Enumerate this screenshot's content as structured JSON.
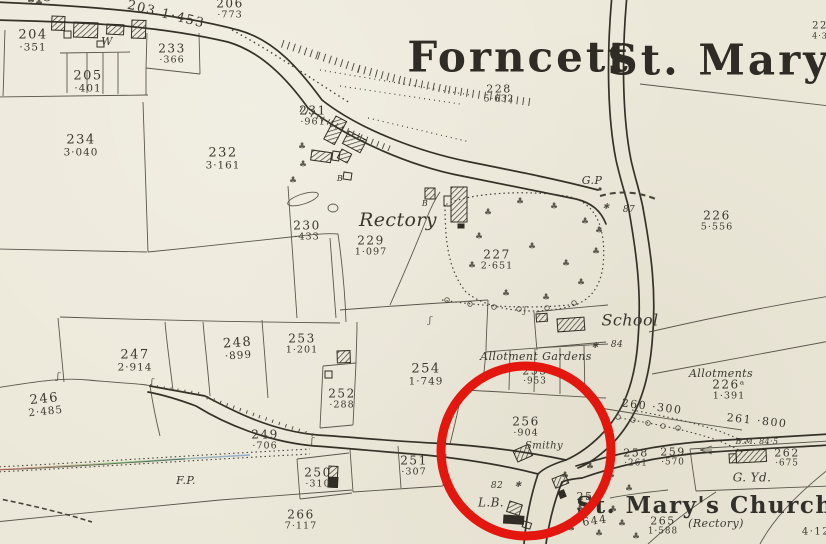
{
  "map": {
    "sheet_title": "Forncett St. Mary",
    "colors": {
      "paper": "#ece8d9",
      "ink": "#3a382e",
      "annotation_red": "#e3170e"
    },
    "annotation": {
      "shape": "circle",
      "purpose": "highlight-smithy-parcel-256"
    },
    "labels": [
      {
        "name": "title-forncett",
        "lines": [
          "Forncett"
        ],
        "x": 519,
        "y": 58,
        "size": 42,
        "style": "title"
      },
      {
        "name": "title-st-mary",
        "lines": [
          "St. Mary"
        ],
        "x": 719,
        "y": 61,
        "size": 42,
        "style": "title"
      },
      {
        "name": "label-st-marys-church",
        "lines": [
          "St. Mary's Church"
        ],
        "x": 705,
        "y": 506,
        "size": 23,
        "style": "title2"
      },
      {
        "name": "parcel-204",
        "lines": [
          "204",
          "·351"
        ],
        "x": 33,
        "y": 41,
        "size": 13,
        "style": "num"
      },
      {
        "name": "parcel-205",
        "lines": [
          "205",
          "·401"
        ],
        "x": 88,
        "y": 82,
        "size": 13,
        "style": "num"
      },
      {
        "name": "parcel-203",
        "lines": [
          "203 1·453"
        ],
        "x": 166,
        "y": 15,
        "size": 13,
        "style": "num",
        "rot": 14
      },
      {
        "name": "parcel-206",
        "lines": [
          "206",
          "·773"
        ],
        "x": 230,
        "y": 9,
        "size": 12,
        "style": "num"
      },
      {
        "name": "parcel-233",
        "lines": [
          "233",
          "·366"
        ],
        "x": 172,
        "y": 54,
        "size": 12,
        "style": "num"
      },
      {
        "name": "parcel-234",
        "lines": [
          "234",
          "3·040"
        ],
        "x": 81,
        "y": 146,
        "size": 13,
        "style": "num"
      },
      {
        "name": "parcel-232",
        "lines": [
          "232",
          "3·161"
        ],
        "x": 223,
        "y": 159,
        "size": 13,
        "style": "num"
      },
      {
        "name": "parcel-231",
        "lines": [
          "231",
          "·961"
        ],
        "x": 313,
        "y": 116,
        "size": 12,
        "style": "num"
      },
      {
        "name": "parcel-230",
        "lines": [
          "230",
          "·433"
        ],
        "x": 307,
        "y": 231,
        "size": 12,
        "style": "num"
      },
      {
        "name": "label-rectory",
        "lines": [
          "Rectory"
        ],
        "x": 398,
        "y": 220,
        "size": 19,
        "style": "italic"
      },
      {
        "name": "parcel-229",
        "lines": [
          "229",
          "1·097"
        ],
        "x": 371,
        "y": 246,
        "size": 12,
        "style": "num"
      },
      {
        "name": "parcel-228",
        "lines": [
          "228",
          "5·632"
        ],
        "x": 499,
        "y": 94,
        "size": 11,
        "style": "num"
      },
      {
        "name": "parcel-227",
        "lines": [
          "227",
          "2·651"
        ],
        "x": 497,
        "y": 260,
        "size": 12,
        "style": "num"
      },
      {
        "name": "parcel-226",
        "lines": [
          "226",
          "5·556"
        ],
        "x": 717,
        "y": 221,
        "size": 12,
        "style": "num"
      },
      {
        "name": "parcel-22x-partial",
        "lines": [
          "22",
          "4·3"
        ],
        "x": 820,
        "y": 31,
        "size": 10,
        "style": "num"
      },
      {
        "name": "label-gp",
        "lines": [
          "G.P"
        ],
        "x": 592,
        "y": 181,
        "size": 11,
        "style": "italic"
      },
      {
        "name": "spot-height-87",
        "lines": [
          "87"
        ],
        "x": 629,
        "y": 211,
        "size": 9,
        "style": "italic"
      },
      {
        "name": "label-school",
        "lines": [
          "School"
        ],
        "x": 630,
        "y": 321,
        "size": 16,
        "style": "italic"
      },
      {
        "name": "spot-height-84",
        "lines": [
          "84"
        ],
        "x": 617,
        "y": 346,
        "size": 9,
        "style": "italic"
      },
      {
        "name": "label-allotments",
        "lines": [
          "Allotments"
        ],
        "x": 721,
        "y": 374,
        "size": 11,
        "style": "italic"
      },
      {
        "name": "parcel-226a",
        "lines": [
          "226ᵃ",
          "1·391"
        ],
        "x": 729,
        "y": 390,
        "size": 12,
        "style": "num"
      },
      {
        "name": "parcel-247",
        "lines": [
          "247",
          "2·914"
        ],
        "x": 135,
        "y": 361,
        "size": 13,
        "style": "num"
      },
      {
        "name": "parcel-248",
        "lines": [
          "248",
          "·899"
        ],
        "x": 238,
        "y": 349,
        "size": 13,
        "style": "num",
        "rot": -4
      },
      {
        "name": "parcel-253",
        "lines": [
          "253",
          "1·201"
        ],
        "x": 302,
        "y": 344,
        "size": 12,
        "style": "num"
      },
      {
        "name": "parcel-246",
        "lines": [
          "246",
          "2·485"
        ],
        "x": 45,
        "y": 405,
        "size": 13,
        "style": "num",
        "rot": -6
      },
      {
        "name": "parcel-249",
        "lines": [
          "249",
          "·706"
        ],
        "x": 265,
        "y": 440,
        "size": 12,
        "style": "num"
      },
      {
        "name": "parcel-250",
        "lines": [
          "250",
          "·310"
        ],
        "x": 318,
        "y": 478,
        "size": 12,
        "style": "num"
      },
      {
        "name": "parcel-251",
        "lines": [
          "251",
          "·307"
        ],
        "x": 414,
        "y": 466,
        "size": 12,
        "style": "num"
      },
      {
        "name": "label-fp",
        "lines": [
          "F.P."
        ],
        "x": 186,
        "y": 481,
        "size": 11,
        "style": "italic"
      },
      {
        "name": "parcel-266",
        "lines": [
          "266",
          "7·117"
        ],
        "x": 301,
        "y": 520,
        "size": 12,
        "style": "num"
      },
      {
        "name": "parcel-252",
        "lines": [
          "252",
          "·288"
        ],
        "x": 342,
        "y": 399,
        "size": 12,
        "style": "num"
      },
      {
        "name": "parcel-254",
        "lines": [
          "254",
          "1·749"
        ],
        "x": 426,
        "y": 375,
        "size": 13,
        "style": "num"
      },
      {
        "name": "label-allotment-gardens",
        "lines": [
          "Allotment Gardens"
        ],
        "x": 536,
        "y": 357,
        "size": 11,
        "style": "italic"
      },
      {
        "name": "parcel-255",
        "lines": [
          "255",
          "·953"
        ],
        "x": 535,
        "y": 376,
        "size": 11,
        "style": "num"
      },
      {
        "name": "parcel-256",
        "lines": [
          "256",
          "·904"
        ],
        "x": 526,
        "y": 427,
        "size": 12,
        "style": "num"
      },
      {
        "name": "label-smithy",
        "lines": [
          "Smithy"
        ],
        "x": 544,
        "y": 447,
        "size": 10,
        "style": "italic"
      },
      {
        "name": "spot-height-82",
        "lines": [
          "82"
        ],
        "x": 497,
        "y": 487,
        "size": 9,
        "style": "italic"
      },
      {
        "name": "label-lb",
        "lines": [
          "L.B."
        ],
        "x": 491,
        "y": 503,
        "size": 12,
        "style": "italic"
      },
      {
        "name": "parcel-260",
        "lines": [
          "260 ·300"
        ],
        "x": 652,
        "y": 407,
        "size": 11,
        "style": "num",
        "rot": 7
      },
      {
        "name": "parcel-261",
        "lines": [
          "261 ·800"
        ],
        "x": 757,
        "y": 421,
        "size": 11,
        "style": "num",
        "rot": 6
      },
      {
        "name": "parcel-258",
        "lines": [
          "258",
          "·261"
        ],
        "x": 636,
        "y": 458,
        "size": 11,
        "style": "num"
      },
      {
        "name": "parcel-259",
        "lines": [
          "259",
          "·570"
        ],
        "x": 673,
        "y": 457,
        "size": 11,
        "style": "num"
      },
      {
        "name": "benchmark-bm-845",
        "lines": [
          "B.M. 84·5"
        ],
        "x": 757,
        "y": 442,
        "size": 8,
        "style": "italic"
      },
      {
        "name": "parcel-262",
        "lines": [
          "262",
          "·675"
        ],
        "x": 787,
        "y": 458,
        "size": 11,
        "style": "num"
      },
      {
        "name": "label-g-yd",
        "lines": [
          "G. Yd."
        ],
        "x": 752,
        "y": 478,
        "size": 12,
        "style": "italic"
      },
      {
        "name": "parcel-265",
        "lines": [
          "265",
          "1·588"
        ],
        "x": 663,
        "y": 526,
        "size": 11,
        "style": "num"
      },
      {
        "name": "label-rectory-paren",
        "lines": [
          "(Rectory)"
        ],
        "x": 716,
        "y": 524,
        "size": 11,
        "style": "italic"
      },
      {
        "name": "parcel-partial-412",
        "lines": [
          "4·12"
        ],
        "x": 816,
        "y": 533,
        "size": 10,
        "style": "num"
      },
      {
        "name": "parcel-257-partial",
        "lines": [
          "25"
        ],
        "x": 585,
        "y": 497,
        "size": 11,
        "style": "num"
      },
      {
        "name": "parcel-257-area-partial",
        "lines": [
          "644"
        ],
        "x": 595,
        "y": 521,
        "size": 11,
        "style": "num",
        "rot": -8
      },
      {
        "name": "label-well-w",
        "lines": [
          "W"
        ],
        "x": 107,
        "y": 42,
        "size": 11,
        "style": "italic"
      },
      {
        "name": "label-b-1",
        "lines": [
          "B"
        ],
        "x": 340,
        "y": 179,
        "size": 8,
        "style": "italic"
      },
      {
        "name": "label-b-2",
        "lines": [
          "B"
        ],
        "x": 425,
        "y": 204,
        "size": 8,
        "style": "italic"
      },
      {
        "name": "boundary-marker-1",
        "lines": [
          "✱"
        ],
        "x": 606,
        "y": 207,
        "size": 8,
        "style": "mark"
      },
      {
        "name": "boundary-marker-2",
        "lines": [
          "✱"
        ],
        "x": 595,
        "y": 346,
        "size": 8,
        "style": "mark"
      },
      {
        "name": "boundary-marker-3",
        "lines": [
          "✱"
        ],
        "x": 518,
        "y": 485,
        "size": 8,
        "style": "mark"
      },
      {
        "name": "gate-mark-1",
        "lines": [
          "ʃ"
        ],
        "x": 58,
        "y": 378,
        "size": 9,
        "style": "mark"
      },
      {
        "name": "gate-mark-2",
        "lines": [
          "ʃ"
        ],
        "x": 152,
        "y": 384,
        "size": 9,
        "style": "mark"
      },
      {
        "name": "gate-mark-3",
        "lines": [
          "ʃ"
        ],
        "x": 312,
        "y": 443,
        "size": 9,
        "style": "mark"
      },
      {
        "name": "gate-mark-4",
        "lines": [
          "ʃ"
        ],
        "x": 430,
        "y": 322,
        "size": 9,
        "style": "mark"
      },
      {
        "name": "gate-mark-5",
        "lines": [
          "ʃ"
        ],
        "x": 525,
        "y": 312,
        "size": 9,
        "style": "mark"
      }
    ]
  }
}
